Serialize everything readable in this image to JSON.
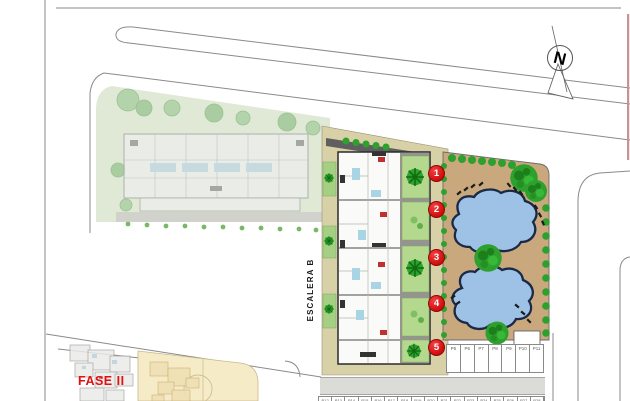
{
  "labels": {
    "escalera": "ESCALERA B",
    "fase": "FASE II",
    "compass_n": "N"
  },
  "markers": [
    "1",
    "2",
    "3",
    "4",
    "5"
  ],
  "parking": {
    "upper_row": [
      "P5",
      "P6",
      "P7",
      "P8",
      "P9",
      "P10",
      "P11"
    ],
    "bottom_row": [
      "P12",
      "P13",
      "P14",
      "P15",
      "P16",
      "P17",
      "P18",
      "P19",
      "P20",
      "P21",
      "P22",
      "P23",
      "P24",
      "P25",
      "P26",
      "P27",
      "P28"
    ]
  },
  "icons": {
    "compass": "north-arrow-icon",
    "palm": "palm-tree-icon",
    "bush": "bush-icon",
    "lounger": "sun-lounger-icon",
    "pool": "swimming-pool-shape"
  },
  "colors": {
    "marker_red": "#e01111",
    "fase_red": "#e01010",
    "pool_fill": "#9ec2e6",
    "pool_outline": "#1a2946",
    "deck_tan": "#c9a87d",
    "garden_green": "#b4d98e",
    "palm_green": "#2fa12f",
    "site_cream": "#d8d0a6",
    "phase2_green": "#dfe9d6",
    "bottom_cream": "#f6ebc7",
    "road_gray": "#888888"
  }
}
